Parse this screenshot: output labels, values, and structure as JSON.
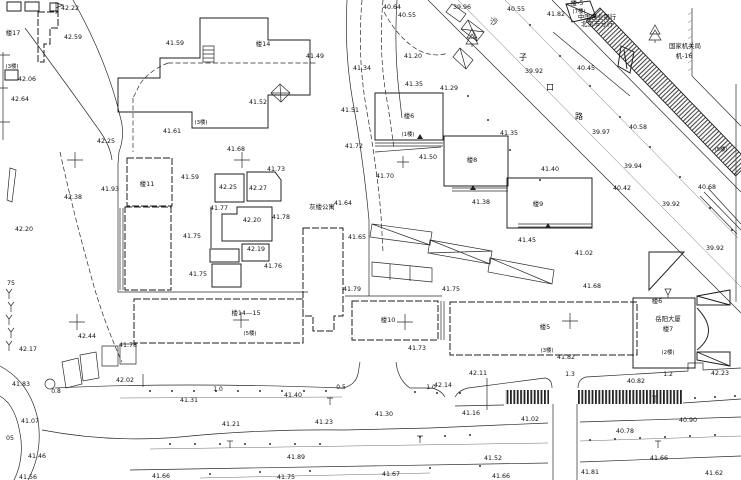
{
  "map": {
    "background": "#ffffff",
    "ink": "#2b2b2b",
    "label_groups": {
      "elevations": {
        "cls": "lbl-elev",
        "items": [
          {
            "x": 70,
            "y": 10,
            "t": "42.22"
          },
          {
            "x": 73,
            "y": 39,
            "t": "42.59"
          },
          {
            "x": 27,
            "y": 81,
            "t": "42.06"
          },
          {
            "x": 20,
            "y": 101,
            "t": "42.64"
          },
          {
            "x": 175,
            "y": 45,
            "t": "41.59"
          },
          {
            "x": 106,
            "y": 143,
            "t": "42.25"
          },
          {
            "x": 172,
            "y": 133,
            "t": "41.61"
          },
          {
            "x": 258,
            "y": 104,
            "t": "41.52"
          },
          {
            "x": 315,
            "y": 58,
            "t": "41.49"
          },
          {
            "x": 350,
            "y": 112,
            "t": "41.51"
          },
          {
            "x": 392,
            "y": 9,
            "t": "40.64"
          },
          {
            "x": 407,
            "y": 17,
            "t": "40.55"
          },
          {
            "x": 462,
            "y": 9,
            "t": "39.96"
          },
          {
            "x": 413,
            "y": 58,
            "t": "41.20"
          },
          {
            "x": 362,
            "y": 70,
            "t": "41.34"
          },
          {
            "x": 414,
            "y": 86,
            "t": "41.35"
          },
          {
            "x": 449,
            "y": 90,
            "t": "41.29"
          },
          {
            "x": 354,
            "y": 148,
            "t": "41.72"
          },
          {
            "x": 428,
            "y": 159,
            "t": "41.50"
          },
          {
            "x": 385,
            "y": 178,
            "t": "41.70"
          },
          {
            "x": 343,
            "y": 205,
            "t": "41.64"
          },
          {
            "x": 357,
            "y": 239,
            "t": "41.65"
          },
          {
            "x": 236,
            "y": 151,
            "t": "41.68"
          },
          {
            "x": 190,
            "y": 179,
            "t": "41.59"
          },
          {
            "x": 276,
            "y": 171,
            "t": "41.73"
          },
          {
            "x": 228,
            "y": 189,
            "t": "42.25"
          },
          {
            "x": 258,
            "y": 190,
            "t": "42.27"
          },
          {
            "x": 219,
            "y": 210,
            "t": "41.77"
          },
          {
            "x": 252,
            "y": 222,
            "t": "42.20"
          },
          {
            "x": 281,
            "y": 219,
            "t": "41.78"
          },
          {
            "x": 192,
            "y": 238,
            "t": "41.75"
          },
          {
            "x": 256,
            "y": 251,
            "t": "42.19"
          },
          {
            "x": 273,
            "y": 268,
            "t": "41.76"
          },
          {
            "x": 198,
            "y": 276,
            "t": "41.75"
          },
          {
            "x": 110,
            "y": 191,
            "t": "41.93"
          },
          {
            "x": 73,
            "y": 199,
            "t": "42.38"
          },
          {
            "x": 24,
            "y": 231,
            "t": "42.20"
          },
          {
            "x": 87,
            "y": 338,
            "t": "42.44"
          },
          {
            "x": 28,
            "y": 351,
            "t": "42.17"
          },
          {
            "x": 128,
            "y": 347,
            "t": "41.78"
          },
          {
            "x": 21,
            "y": 386,
            "t": "41.83"
          },
          {
            "x": 125,
            "y": 382,
            "t": "42.02"
          },
          {
            "x": 516,
            "y": 11,
            "t": "40.55"
          },
          {
            "x": 556,
            "y": 16,
            "t": "41.82"
          },
          {
            "x": 534,
            "y": 73,
            "t": "39.92"
          },
          {
            "x": 586,
            "y": 70,
            "t": "40.45"
          },
          {
            "x": 638,
            "y": 129,
            "t": "40.58"
          },
          {
            "x": 601,
            "y": 134,
            "t": "39.97"
          },
          {
            "x": 509,
            "y": 135,
            "t": "41.35"
          },
          {
            "x": 550,
            "y": 171,
            "t": "41.40"
          },
          {
            "x": 481,
            "y": 204,
            "t": "41.38"
          },
          {
            "x": 527,
            "y": 242,
            "t": "41.45"
          },
          {
            "x": 633,
            "y": 168,
            "t": "39.94"
          },
          {
            "x": 622,
            "y": 190,
            "t": "40.42"
          },
          {
            "x": 707,
            "y": 189,
            "t": "40.68"
          },
          {
            "x": 671,
            "y": 206,
            "t": "39.92"
          },
          {
            "x": 715,
            "y": 250,
            "t": "39.92"
          },
          {
            "x": 584,
            "y": 255,
            "t": "41.02"
          },
          {
            "x": 592,
            "y": 288,
            "t": "41.68"
          },
          {
            "x": 352,
            "y": 291,
            "t": "41.79"
          },
          {
            "x": 451,
            "y": 291,
            "t": "41.75"
          },
          {
            "x": 417,
            "y": 350,
            "t": "41.73"
          },
          {
            "x": 566,
            "y": 359,
            "t": "41.82"
          },
          {
            "x": 293,
            "y": 397,
            "t": "41.40"
          },
          {
            "x": 189,
            "y": 402,
            "t": "41.31"
          },
          {
            "x": 30,
            "y": 423,
            "t": "41.07"
          },
          {
            "x": 231,
            "y": 426,
            "t": "41.21"
          },
          {
            "x": 324,
            "y": 424,
            "t": "41.23"
          },
          {
            "x": 384,
            "y": 416,
            "t": "41.30"
          },
          {
            "x": 471,
            "y": 415,
            "t": "41.16"
          },
          {
            "x": 443,
            "y": 387,
            "t": "42.14"
          },
          {
            "x": 478,
            "y": 375,
            "t": "42.11"
          },
          {
            "x": 636,
            "y": 383,
            "t": "40.82"
          },
          {
            "x": 530,
            "y": 421,
            "t": "41.02"
          },
          {
            "x": 688,
            "y": 422,
            "t": "40.90"
          },
          {
            "x": 625,
            "y": 433,
            "t": "40.78"
          },
          {
            "x": 720,
            "y": 375,
            "t": "42.23"
          },
          {
            "x": 37,
            "y": 458,
            "t": "41.46"
          },
          {
            "x": 28,
            "y": 479,
            "t": "41.56"
          },
          {
            "x": 161,
            "y": 478,
            "t": "41.66"
          },
          {
            "x": 296,
            "y": 459,
            "t": "41.89"
          },
          {
            "x": 286,
            "y": 479,
            "t": "41.75"
          },
          {
            "x": 391,
            "y": 476,
            "t": "41.67"
          },
          {
            "x": 493,
            "y": 460,
            "t": "41.52"
          },
          {
            "x": 501,
            "y": 478,
            "t": "41.66"
          },
          {
            "x": 659,
            "y": 460,
            "t": "41.66"
          },
          {
            "x": 590,
            "y": 474,
            "t": "41.81"
          },
          {
            "x": 714,
            "y": 475,
            "t": "41.62"
          },
          {
            "x": 10,
            "y": 440,
            "t": "05"
          },
          {
            "x": 11,
            "y": 285,
            "t": "75"
          }
        ]
      },
      "road_widths": {
        "cls": "lbl-width",
        "items": [
          {
            "x": 56,
            "y": 393,
            "t": "0.8"
          },
          {
            "x": 218,
            "y": 391,
            "t": "1.0"
          },
          {
            "x": 341,
            "y": 389,
            "t": "0.5"
          },
          {
            "x": 431,
            "y": 389,
            "t": "1.0"
          },
          {
            "x": 570,
            "y": 376,
            "t": "1.3"
          },
          {
            "x": 668,
            "y": 376,
            "t": "1.2"
          }
        ]
      },
      "buildings": {
        "cls": "lbl-bldg",
        "items": [
          {
            "x": 13,
            "y": 35,
            "t": "楼17"
          },
          {
            "x": 263,
            "y": 46,
            "t": "楼14"
          },
          {
            "x": 147,
            "y": 186,
            "t": "楼11"
          },
          {
            "x": 409,
            "y": 118,
            "t": "楼6"
          },
          {
            "x": 472,
            "y": 162,
            "t": "楼8"
          },
          {
            "x": 538,
            "y": 206,
            "t": "楼9"
          },
          {
            "x": 388,
            "y": 322,
            "t": "楼10"
          },
          {
            "x": 246,
            "y": 315,
            "t": "楼14—15"
          },
          {
            "x": 545,
            "y": 329,
            "t": "楼5"
          },
          {
            "x": 668,
            "y": 331,
            "t": "楼7"
          },
          {
            "x": 657,
            "y": 303,
            "t": "楼6",
            "s": 5
          },
          {
            "x": 577,
            "y": 5,
            "t": "楼-5",
            "s": 5.5
          },
          {
            "x": 684,
            "y": 58,
            "t": "机-16",
            "s": 5.8
          }
        ]
      },
      "floors": {
        "cls": "lbl-floor",
        "items": [
          {
            "x": 12,
            "y": 68,
            "t": "(3楼)"
          },
          {
            "x": 201,
            "y": 124,
            "t": "(3楼)"
          },
          {
            "x": 408,
            "y": 136,
            "t": "(1楼)"
          },
          {
            "x": 579,
            "y": 13,
            "t": "(7楼)"
          },
          {
            "x": 721,
            "y": 151,
            "t": "(5楼)"
          },
          {
            "x": 250,
            "y": 335,
            "t": "(5楼)"
          },
          {
            "x": 547,
            "y": 352,
            "t": "(3楼)"
          },
          {
            "x": 668,
            "y": 354,
            "t": "(2楼)"
          }
        ]
      },
      "places": {
        "cls": "lbl-place",
        "items": [
          {
            "x": 322,
            "y": 209,
            "t": "灰楼公寓",
            "s": 5.6
          },
          {
            "x": 668,
            "y": 321,
            "t": "岳阳大厦",
            "s": 6
          },
          {
            "x": 597,
            "y": 19,
            "t": "中国农业银行",
            "s": 4.6
          },
          {
            "x": 597,
            "y": 26,
            "t": "北京市分行",
            "s": 4.6
          },
          {
            "x": 685,
            "y": 48,
            "t": "国家机关局",
            "s": 5.4
          }
        ]
      },
      "street_name": {
        "cls": "lbl-street",
        "items": [
          {
            "x": 494,
            "y": 24,
            "t": "沙"
          },
          {
            "x": 523,
            "y": 60,
            "t": "子"
          },
          {
            "x": 550,
            "y": 90,
            "t": "口"
          },
          {
            "x": 579,
            "y": 119,
            "t": "路"
          }
        ]
      }
    }
  }
}
